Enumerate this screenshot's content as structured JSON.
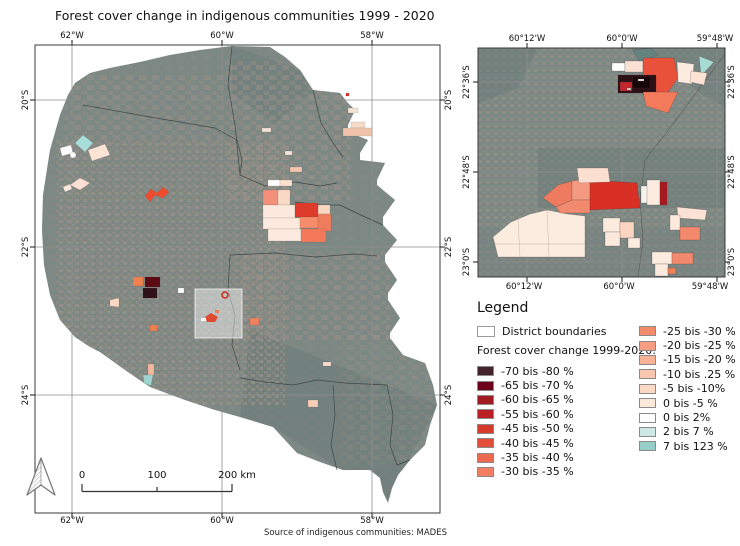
{
  "title": "Forest cover change in indigenous communities 1999 - 2020",
  "source": "Source of indigenous communities: MADES",
  "main_map": {
    "x_labels": [
      "62°W",
      "60°W",
      "58°W"
    ],
    "y_labels": [
      "20°S",
      "22°S",
      "24°S"
    ]
  },
  "inset_map": {
    "x_labels": [
      "60°12'W",
      "60°0'W",
      "59°48'W"
    ],
    "y_labels": [
      "22°36'S",
      "22°48'S",
      "23°0'S"
    ]
  },
  "scalebar": {
    "labels": [
      "0",
      "100",
      "200 km"
    ]
  },
  "legend": {
    "heading": "Legend",
    "district_boundaries_label": "District boundaries",
    "subtitle": "Forest cover change 1999-2020:",
    "left_items": [
      {
        "label": "-70 bis -80 %",
        "color": "#44232b"
      },
      {
        "label": "-65 bis -70 %",
        "color": "#6e0019"
      },
      {
        "label": "-60 bis -65 %",
        "color": "#a31b22"
      },
      {
        "label": "-55 bis -60 %",
        "color": "#ba1f26"
      },
      {
        "label": "-45 bis -50 %",
        "color": "#d53a2c"
      },
      {
        "label": "-40 bis -45 %",
        "color": "#e14f3b"
      },
      {
        "label": "-35 bis -40 %",
        "color": "#ec6850"
      },
      {
        "label": "-30 bis -35 %",
        "color": "#f37e61"
      }
    ],
    "right_items": [
      {
        "label": "-25 bis -30 %",
        "color": "#f58a6b"
      },
      {
        "label": "-20 bis -25 %",
        "color": "#f79e82"
      },
      {
        "label": "-15 bis -20 %",
        "color": "#f9b296"
      },
      {
        "label": "-10 bis .25 %",
        "color": "#fbc6ae"
      },
      {
        "label": "-5 bis -10%",
        "color": "#fdd9c5"
      },
      {
        "label": "0 bis -5 %",
        "color": "#fde9dc"
      },
      {
        "label": "0 bis 2%",
        "color": "#ffffff"
      },
      {
        "label": "2 bis 7 %",
        "color": "#cbe8e4"
      },
      {
        "label": "7 bis 123 %",
        "color": "#98cec8"
      }
    ]
  },
  "colors": {
    "satellite_base": "#7b8884",
    "farmland": "#a5938a",
    "forest_dark": "#6b7a77",
    "outside_region": "#ffffff",
    "grid_line": "#8f8f8f",
    "frame": "#3a3a3a",
    "strong_red": "#d93026",
    "highlight_box": "#ffffff"
  }
}
